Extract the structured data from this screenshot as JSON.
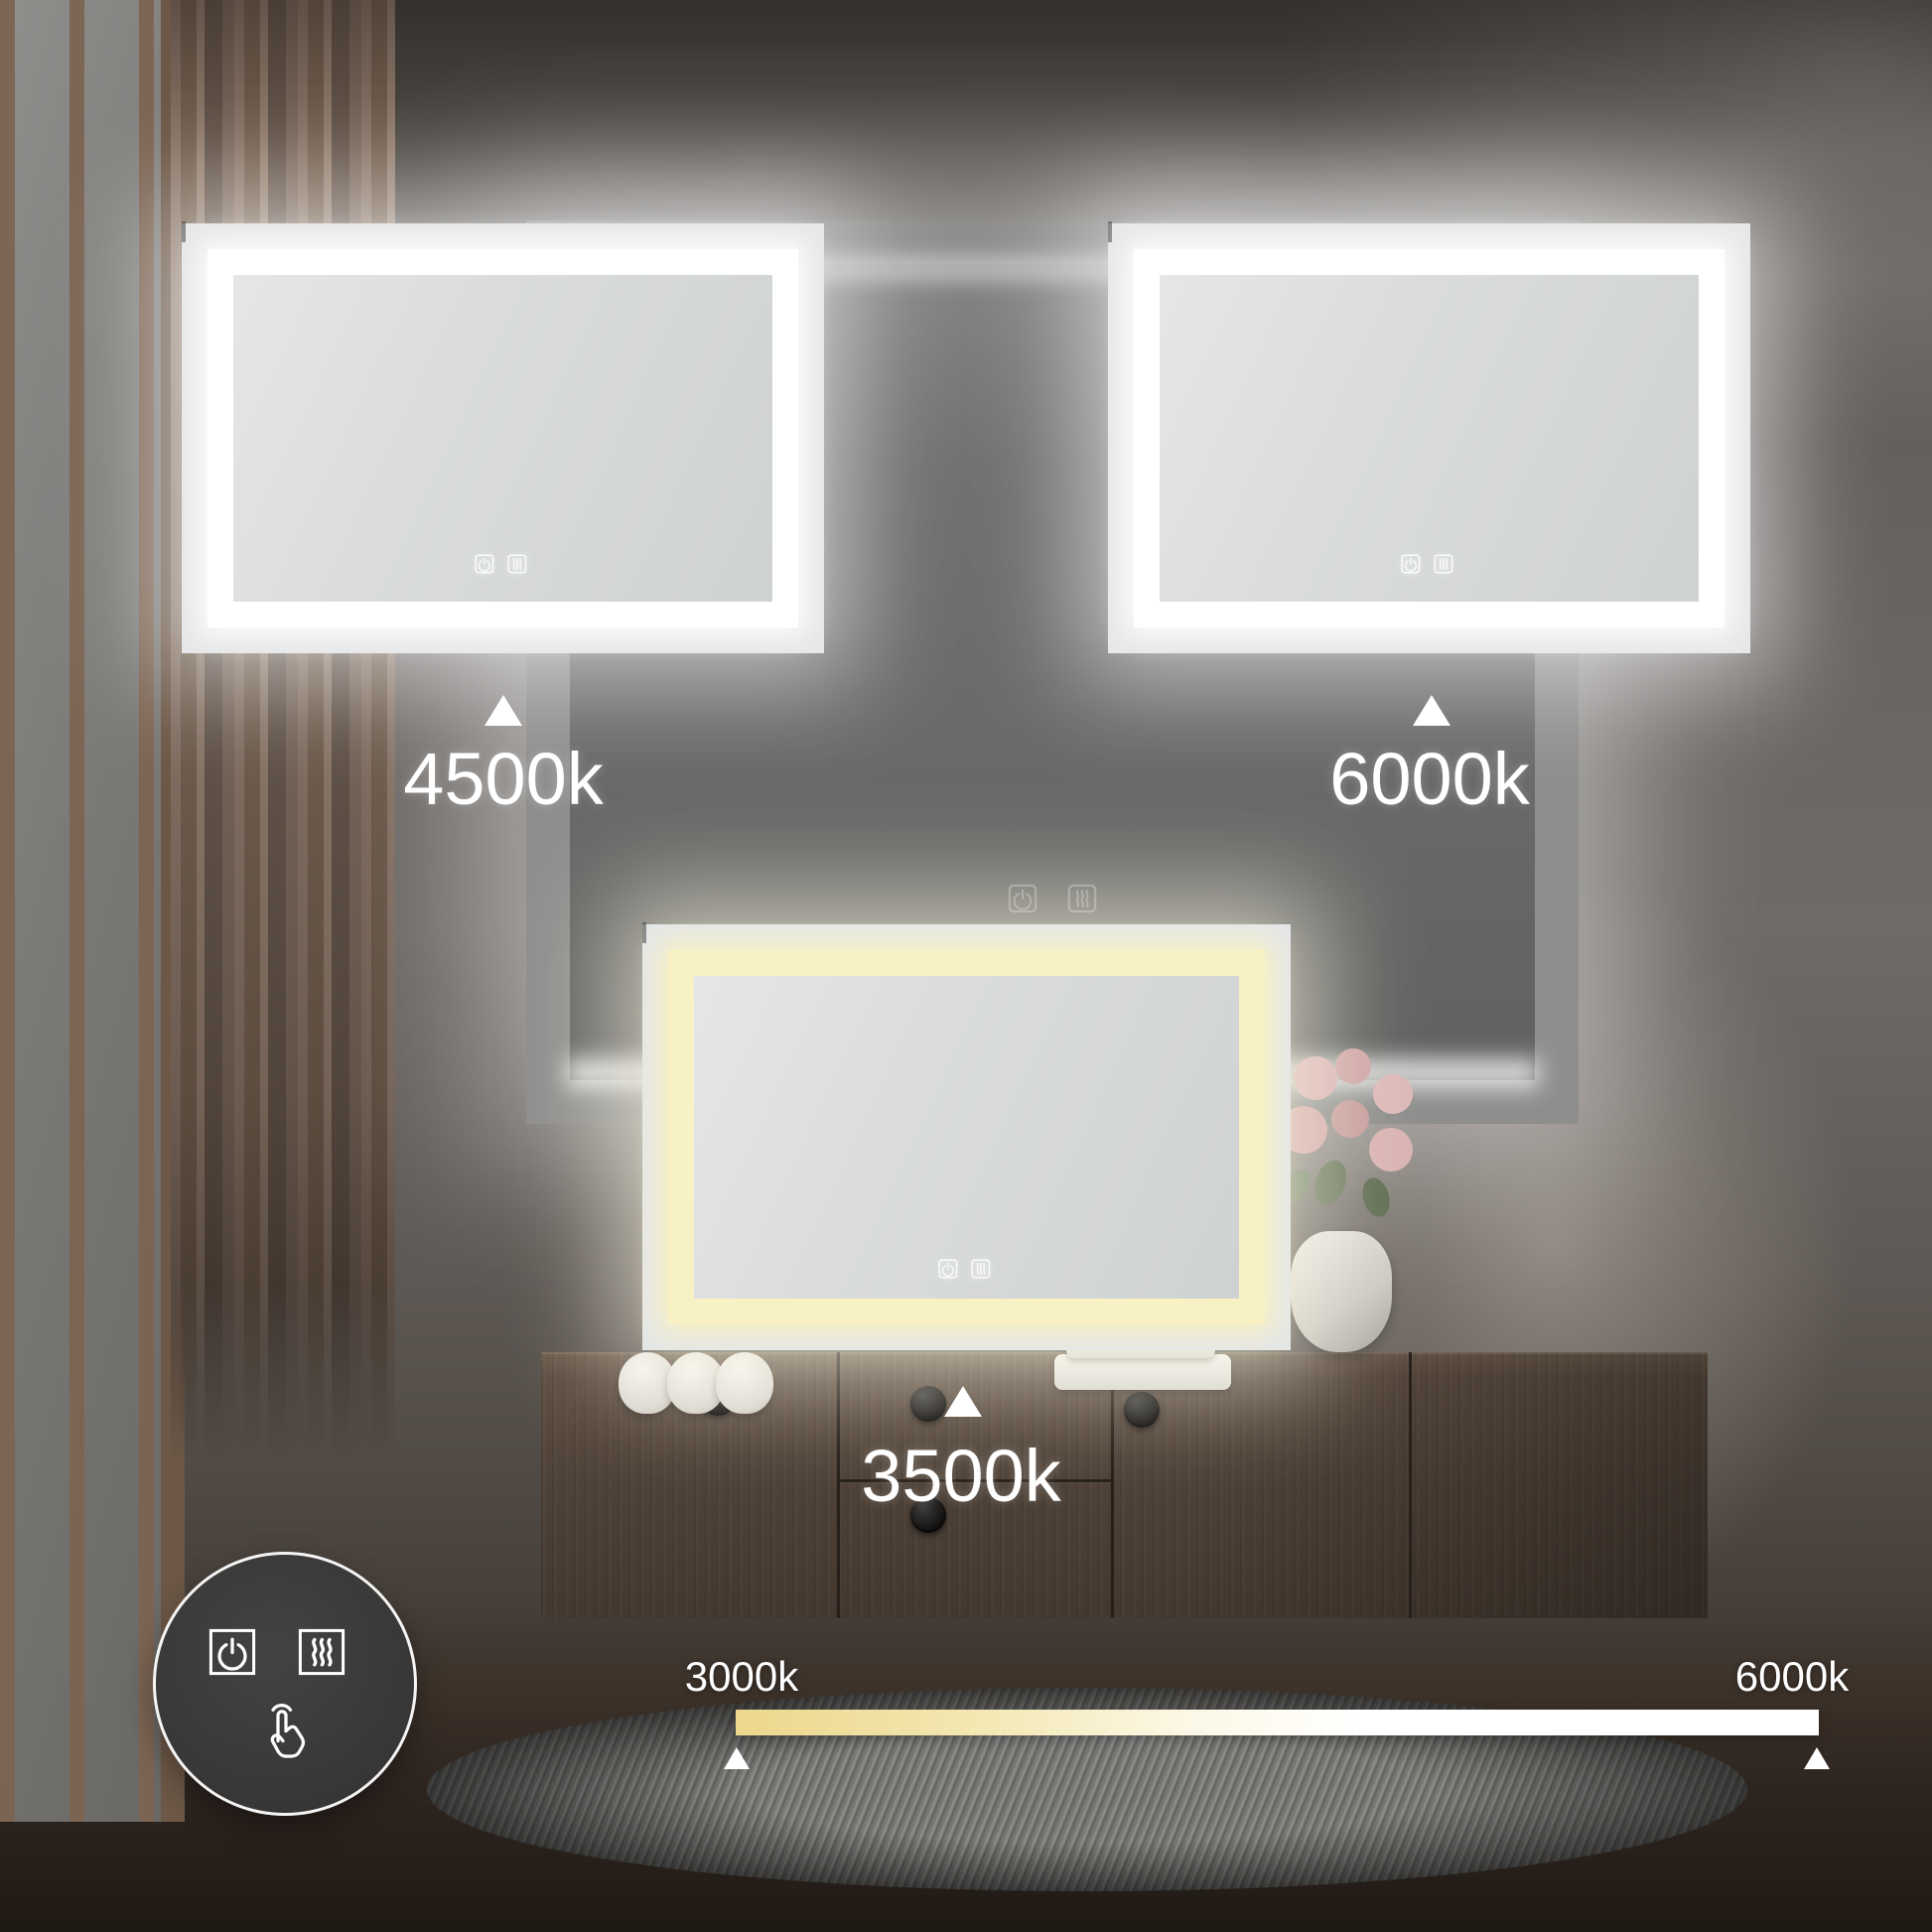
{
  "mirrors": {
    "top_left": {
      "temperature": "4500k"
    },
    "top_right": {
      "temperature": "6000k"
    },
    "center": {
      "temperature": "3500k"
    }
  },
  "slider": {
    "min_label": "3000k",
    "max_label": "6000k"
  },
  "icons": {
    "mirror_buttons": [
      "power-icon",
      "defogger-icon"
    ],
    "badge": [
      "power-icon",
      "defogger-icon",
      "touch-gesture-icon"
    ]
  },
  "colors": {
    "led_warm": "#f8f1c4",
    "led_cool": "#ffffff",
    "slider_start": "#ecd78b",
    "slider_end": "#ffffff",
    "wall": "#5f5a56",
    "wood": "#5d4d41",
    "badge_bg": "#393736",
    "label_text": "#ffffff"
  }
}
